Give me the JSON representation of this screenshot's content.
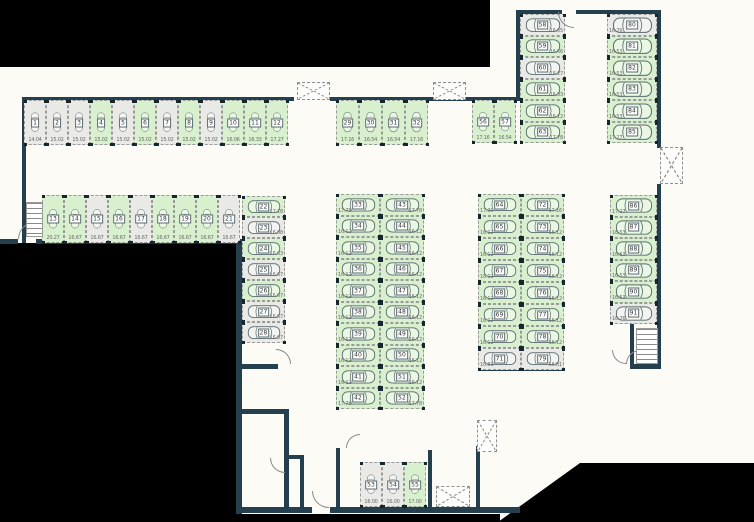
{
  "palette": {
    "wall": "#24404f",
    "free_fill": "#d8f0cd",
    "occupied_fill": "#e9e9e6",
    "stall_border": "#9a9a9a",
    "car_outline": "#5a6b70",
    "dim_text": "#6b6b6b",
    "number_text": "#333333",
    "outside_mask": "#000000"
  },
  "legend": {
    "free_status": "free",
    "occupied_status": "occupied"
  },
  "stall_fields": [
    "number",
    "x",
    "y",
    "w",
    "h",
    "orientation",
    "status",
    "dim_label",
    "dim_pos"
  ],
  "stalls": [
    [
      "1",
      24,
      100,
      22,
      45,
      "v",
      "occupied",
      "14.04",
      "b"
    ],
    [
      "2",
      46,
      100,
      22,
      45,
      "v",
      "occupied",
      "15.02",
      "b"
    ],
    [
      "3",
      68,
      100,
      22,
      45,
      "v",
      "occupied",
      "15.02",
      "b"
    ],
    [
      "4",
      90,
      100,
      22,
      45,
      "v",
      "free",
      "15.02",
      "b"
    ],
    [
      "5",
      112,
      100,
      22,
      45,
      "v",
      "occupied",
      "15.02",
      "b"
    ],
    [
      "6",
      134,
      100,
      22,
      45,
      "v",
      "free",
      "15.02",
      "b"
    ],
    [
      "7",
      156,
      100,
      22,
      45,
      "v",
      "occupied",
      "15.02",
      "b"
    ],
    [
      "8",
      178,
      100,
      22,
      45,
      "v",
      "free",
      "15.02",
      "b"
    ],
    [
      "9",
      200,
      100,
      22,
      45,
      "v",
      "occupied",
      "15.02",
      "b"
    ],
    [
      "10",
      222,
      100,
      22,
      45,
      "v",
      "free",
      "16.06",
      "b"
    ],
    [
      "11",
      244,
      100,
      22,
      45,
      "v",
      "free",
      "16.33",
      "b"
    ],
    [
      "12",
      266,
      100,
      22,
      45,
      "v",
      "free",
      "17.27",
      "b"
    ],
    [
      "29",
      336,
      100,
      23,
      45,
      "v",
      "free",
      "17.16",
      "b"
    ],
    [
      "30",
      359,
      100,
      23,
      45,
      "v",
      "free",
      "16.54",
      "b"
    ],
    [
      "31",
      382,
      100,
      23,
      45,
      "v",
      "free",
      "16.54",
      "b"
    ],
    [
      "32",
      405,
      100,
      23,
      45,
      "v",
      "free",
      "17.16",
      "b"
    ],
    [
      "56",
      472,
      100,
      22,
      43,
      "v",
      "free",
      "17.16",
      "b"
    ],
    [
      "57",
      494,
      100,
      22,
      43,
      "v",
      "free",
      "16.54",
      "b"
    ],
    [
      "13",
      42,
      195,
      22,
      48,
      "v",
      "free",
      "20.27",
      "b"
    ],
    [
      "14",
      64,
      195,
      22,
      48,
      "v",
      "free",
      "16.67",
      "b"
    ],
    [
      "15",
      86,
      195,
      22,
      48,
      "v",
      "occupied",
      "16.67",
      "b"
    ],
    [
      "16",
      108,
      195,
      22,
      48,
      "v",
      "free",
      "16.67",
      "b"
    ],
    [
      "17",
      130,
      195,
      22,
      48,
      "v",
      "occupied",
      "16.67",
      "b"
    ],
    [
      "18",
      152,
      195,
      22,
      48,
      "v",
      "free",
      "16.67",
      "b"
    ],
    [
      "19",
      174,
      195,
      22,
      48,
      "v",
      "free",
      "16.67",
      "b"
    ],
    [
      "20",
      196,
      195,
      22,
      48,
      "v",
      "free",
      "16.67",
      "b"
    ],
    [
      "21",
      218,
      195,
      22,
      48,
      "v",
      "occupied",
      "16.67",
      "b"
    ],
    [
      "22",
      242,
      196,
      43,
      21,
      "h",
      "free",
      "17.18",
      "br"
    ],
    [
      "23",
      242,
      217,
      43,
      21,
      "h",
      "occupied",
      "16.08",
      "br"
    ],
    [
      "24",
      242,
      238,
      43,
      21,
      "h",
      "free",
      "16.63",
      "br"
    ],
    [
      "25",
      242,
      259,
      43,
      21,
      "h",
      "occupied",
      "16.67",
      "br"
    ],
    [
      "26",
      242,
      280,
      43,
      21,
      "h",
      "free",
      "16.67",
      "br"
    ],
    [
      "27",
      242,
      301,
      43,
      21,
      "h",
      "occupied",
      "16.67",
      "br"
    ],
    [
      "28",
      242,
      322,
      43,
      21,
      "h",
      "occupied",
      "16.07",
      "br"
    ],
    [
      "33",
      336,
      194,
      44,
      21.5,
      "h",
      "free",
      "17.78",
      "bl"
    ],
    [
      "34",
      336,
      215.5,
      44,
      21.5,
      "h",
      "free",
      "16.12",
      "bl"
    ],
    [
      "35",
      336,
      237,
      44,
      21.5,
      "h",
      "free",
      "16.12",
      "bl"
    ],
    [
      "36",
      336,
      258.5,
      44,
      21.5,
      "h",
      "free",
      "16.12",
      "bl"
    ],
    [
      "37",
      336,
      280,
      44,
      21.5,
      "h",
      "free",
      "16.12",
      "bl"
    ],
    [
      "38",
      336,
      301.5,
      44,
      21.5,
      "h",
      "free",
      "16.12",
      "bl"
    ],
    [
      "39",
      336,
      323,
      44,
      21.5,
      "h",
      "free",
      "16.12",
      "bl"
    ],
    [
      "40",
      336,
      344.5,
      44,
      21.5,
      "h",
      "free",
      "16.12",
      "bl"
    ],
    [
      "41",
      336,
      366,
      44,
      21.5,
      "h",
      "free",
      "16.12",
      "bl"
    ],
    [
      "42",
      336,
      387.5,
      44,
      21.5,
      "h",
      "free",
      "17.78",
      "bl"
    ],
    [
      "43",
      380,
      194,
      44,
      21.5,
      "h",
      "free",
      "17.78",
      "br"
    ],
    [
      "44",
      380,
      215.5,
      44,
      21.5,
      "h",
      "free",
      "16.12",
      "br"
    ],
    [
      "45",
      380,
      237,
      44,
      21.5,
      "h",
      "free",
      "16.12",
      "br"
    ],
    [
      "46",
      380,
      258.5,
      44,
      21.5,
      "h",
      "free",
      "16.12",
      "br"
    ],
    [
      "47",
      380,
      280,
      44,
      21.5,
      "h",
      "free",
      "16.12",
      "br"
    ],
    [
      "48",
      380,
      301.5,
      44,
      21.5,
      "h",
      "free",
      "16.12",
      "br"
    ],
    [
      "49",
      380,
      323,
      44,
      21.5,
      "h",
      "free",
      "16.12",
      "br"
    ],
    [
      "50",
      380,
      344.5,
      44,
      21.5,
      "h",
      "free",
      "16.12",
      "br"
    ],
    [
      "51",
      380,
      366,
      44,
      21.5,
      "h",
      "free",
      "16.12",
      "br"
    ],
    [
      "52",
      380,
      387.5,
      44,
      21.5,
      "h",
      "free",
      "17.78",
      "br"
    ],
    [
      "64",
      478,
      194,
      43,
      22,
      "h",
      "free",
      "17.30",
      "bl"
    ],
    [
      "65",
      478,
      216,
      43,
      22,
      "h",
      "free",
      "16.12",
      "bl"
    ],
    [
      "66",
      478,
      238,
      43,
      22,
      "h",
      "free",
      "16.12",
      "bl"
    ],
    [
      "67",
      478,
      260,
      43,
      22,
      "h",
      "free",
      "16.12",
      "bl"
    ],
    [
      "68",
      478,
      282,
      43,
      22,
      "h",
      "free",
      "16.12",
      "bl"
    ],
    [
      "69",
      478,
      304,
      43,
      22,
      "h",
      "free",
      "16.12",
      "bl"
    ],
    [
      "70",
      478,
      326,
      43,
      22,
      "h",
      "free",
      "16.12",
      "bl"
    ],
    [
      "71",
      478,
      348,
      43,
      22,
      "h",
      "occupied",
      "16.81",
      "bl"
    ],
    [
      "72",
      521,
      194,
      43,
      22,
      "h",
      "free",
      "17.16",
      "br"
    ],
    [
      "73",
      521,
      216,
      43,
      22,
      "h",
      "free",
      "16.12",
      "br"
    ],
    [
      "74",
      521,
      238,
      43,
      22,
      "h",
      "free",
      "16.12",
      "br"
    ],
    [
      "75",
      521,
      260,
      43,
      22,
      "h",
      "free",
      "16.12",
      "br"
    ],
    [
      "76",
      521,
      282,
      43,
      22,
      "h",
      "free",
      "16.12",
      "br"
    ],
    [
      "77",
      521,
      304,
      43,
      22,
      "h",
      "free",
      "16.12",
      "br"
    ],
    [
      "78",
      521,
      326,
      43,
      22,
      "h",
      "free",
      "16.12",
      "br"
    ],
    [
      "79",
      521,
      348,
      43,
      22,
      "h",
      "occupied",
      "16.81",
      "br"
    ],
    [
      "58",
      520,
      14,
      45,
      21.5,
      "h",
      "occupied",
      "16.65",
      "br"
    ],
    [
      "59",
      520,
      35.5,
      45,
      21.5,
      "h",
      "free",
      "16.66",
      "br"
    ],
    [
      "60",
      520,
      57,
      45,
      21.5,
      "h",
      "occupied",
      "16.27",
      "br"
    ],
    [
      "61",
      520,
      78.5,
      45,
      21.5,
      "h",
      "free",
      "16.33",
      "br"
    ],
    [
      "62",
      520,
      100,
      45,
      21.5,
      "h",
      "free",
      "16.12",
      "br"
    ],
    [
      "63",
      520,
      121.5,
      45,
      21.5,
      "h",
      "free",
      "17.78",
      "br"
    ],
    [
      "80",
      607,
      14,
      50,
      21.5,
      "h",
      "occupied",
      "16.76",
      "bl"
    ],
    [
      "81",
      607,
      35.5,
      50,
      21.5,
      "h",
      "free",
      "16.53",
      "bl"
    ],
    [
      "82",
      607,
      57,
      50,
      21.5,
      "h",
      "free",
      "16.53",
      "bl"
    ],
    [
      "83",
      607,
      78.5,
      50,
      21.5,
      "h",
      "free",
      "16.53",
      "bl"
    ],
    [
      "84",
      607,
      100,
      50,
      21.5,
      "h",
      "free",
      "16.53",
      "bl"
    ],
    [
      "85",
      607,
      121.5,
      50,
      21.5,
      "h",
      "free",
      "17.27",
      "bl"
    ],
    [
      "86",
      610,
      195,
      47,
      21.5,
      "h",
      "free",
      "17.27",
      "bl"
    ],
    [
      "87",
      610,
      216.5,
      47,
      21.5,
      "h",
      "free",
      "16.53",
      "bl"
    ],
    [
      "88",
      610,
      238,
      47,
      21.5,
      "h",
      "free",
      "16.53",
      "bl"
    ],
    [
      "89",
      610,
      259.5,
      47,
      21.5,
      "h",
      "free",
      "16.53",
      "bl"
    ],
    [
      "90",
      610,
      281,
      47,
      21.5,
      "h",
      "free",
      "16.53",
      "bl"
    ],
    [
      "91",
      610,
      302.5,
      47,
      21.5,
      "h",
      "occupied",
      "16.76",
      "bl"
    ],
    [
      "53",
      360,
      462,
      22,
      45,
      "v",
      "occupied",
      "16.00",
      "b"
    ],
    [
      "54",
      382,
      462,
      22,
      45,
      "v",
      "occupied",
      "16.00",
      "b"
    ],
    [
      "55",
      404,
      462,
      22,
      45,
      "v",
      "free",
      "17.00",
      "b"
    ]
  ],
  "walls": [
    [
      22,
      97,
      272,
      4
    ],
    [
      330,
      97,
      140,
      4
    ],
    [
      466,
      97,
      54,
      4
    ],
    [
      22,
      97,
      4,
      146
    ],
    [
      0,
      239,
      18,
      5
    ],
    [
      36,
      239,
      206,
      5
    ],
    [
      236,
      243,
      6,
      271
    ],
    [
      516,
      10,
      46,
      4
    ],
    [
      576,
      10,
      85,
      4
    ],
    [
      516,
      14,
      4,
      86
    ],
    [
      657,
      10,
      4,
      138
    ],
    [
      657,
      184,
      4,
      184
    ],
    [
      478,
      366,
      86,
      5
    ],
    [
      630,
      364,
      31,
      5
    ],
    [
      630,
      324,
      4,
      44
    ],
    [
      236,
      364,
      42,
      5
    ],
    [
      236,
      409,
      53,
      5
    ],
    [
      284,
      414,
      5,
      98
    ],
    [
      300,
      455,
      4,
      57
    ],
    [
      284,
      455,
      18,
      4
    ],
    [
      236,
      507,
      76,
      6
    ],
    [
      330,
      507,
      190,
      6
    ],
    [
      336,
      448,
      4,
      64
    ],
    [
      428,
      450,
      4,
      62
    ],
    [
      476,
      446,
      4,
      66
    ]
  ],
  "elevator_shafts": [
    [
      297,
      82,
      33,
      18
    ],
    [
      433,
      82,
      33,
      18
    ],
    [
      660,
      147,
      23,
      37
    ],
    [
      477,
      420,
      20,
      32
    ],
    [
      436,
      486,
      34,
      21
    ]
  ],
  "doors": [
    [
      18,
      222,
      17,
      90
    ],
    [
      558,
      12,
      16,
      0
    ],
    [
      276,
      349,
      15,
      180
    ],
    [
      346,
      434,
      14,
      90
    ],
    [
      612,
      350,
      14,
      0
    ],
    [
      626,
      350,
      14,
      90
    ],
    [
      270,
      458,
      15,
      0
    ],
    [
      312,
      491,
      17,
      0
    ]
  ],
  "stairs": [
    [
      26,
      202,
      15,
      33
    ],
    [
      636,
      328,
      20,
      34
    ]
  ],
  "masked_regions": {
    "rects": [
      [
        0,
        0,
        490,
        67
      ],
      [
        0,
        243,
        236,
        279
      ],
      [
        236,
        514,
        264,
        8
      ]
    ],
    "polygon": [
      [
        498,
        522
      ],
      [
        580,
        463
      ],
      [
        754,
        463
      ],
      [
        754,
        522
      ]
    ]
  }
}
